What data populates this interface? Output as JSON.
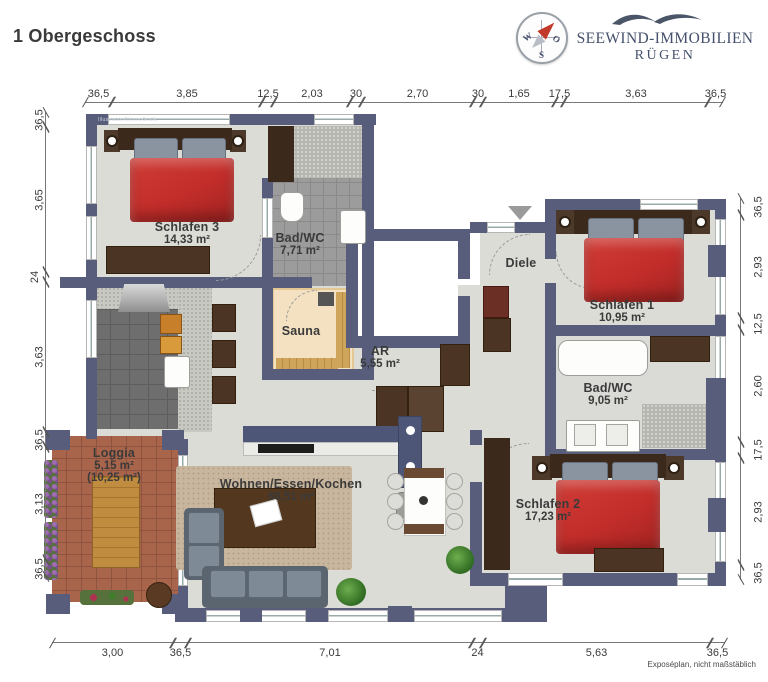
{
  "header": {
    "title": "1 Obergeschoss"
  },
  "logo": {
    "line1": "SEEWIND-IMMOBILIEN",
    "line2": "RÜGEN",
    "compass": {
      "west": "W",
      "east": "O",
      "south": "S"
    }
  },
  "watermark": "Illustration©ImmoGrafik",
  "footer": {
    "note": "Exposéplan, nicht maßstäblich"
  },
  "rooms": {
    "schlafen3": {
      "name": "Schlafen 3",
      "area": "14,33 m²"
    },
    "bad1": {
      "name": "Bad/WC",
      "area": "7,71 m²"
    },
    "sauna": {
      "name": "Sauna"
    },
    "diele": {
      "name": "Diele"
    },
    "schlafen1": {
      "name": "Schlafen 1",
      "area": "10,95 m²"
    },
    "ar": {
      "name": "AR",
      "area": "5,55 m²"
    },
    "bad2": {
      "name": "Bad/WC",
      "area": "9,05 m²"
    },
    "loggia": {
      "name": "Loggia",
      "area": "5,15 m²",
      "area2": "(10,25 m²)"
    },
    "wohnen": {
      "name": "Wohnen/Essen/Kochen",
      "area": "60,51 m²"
    },
    "schlafen2": {
      "name": "Schlafen 2",
      "area": "17,23 m²"
    }
  },
  "dimensions": {
    "top": [
      "36,5",
      "3,85",
      "12,5",
      "2,03",
      "30",
      "2,70",
      "30",
      "1,65",
      "17,5",
      "3,63",
      "36,5"
    ],
    "left": [
      "36,5",
      "3,65",
      "24",
      "3,63",
      "36,5",
      "3,13",
      "36,5"
    ],
    "right": [
      "36,5",
      "2,93",
      "12,5",
      "2,60",
      "17,5",
      "2,93",
      "36,5"
    ],
    "bottom": [
      "3,00",
      "36,5",
      "7,01",
      "24",
      "5,63",
      "36,5"
    ]
  },
  "colors": {
    "wall": "#575d7b",
    "floor": "#dcdcd6",
    "bed": "#c22d2a",
    "loggia": "#a9654c",
    "logo": "#45516c"
  }
}
